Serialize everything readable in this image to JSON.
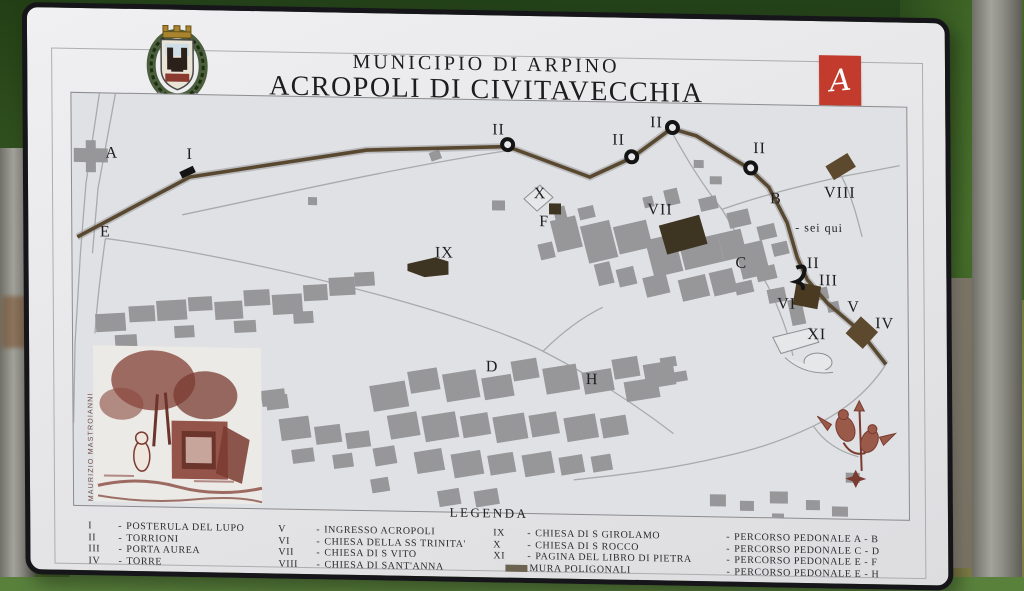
{
  "sign": {
    "title_line1": "MUNICIPIO DI ARPINO",
    "title_line2": "ACROPOLI DI CIVITAVECCHIA",
    "logo_caption": "Archeo Club Arpino",
    "credit": "MAURIZIO MASTROIANNI"
  },
  "map": {
    "you_are_here": "- sei qui",
    "labels": [
      {
        "t": "A",
        "x": 40,
        "y": 60
      },
      {
        "t": "I",
        "x": 118,
        "y": 60
      },
      {
        "t": "E",
        "x": 33,
        "y": 139
      },
      {
        "t": "II",
        "x": 427,
        "y": 30
      },
      {
        "t": "II",
        "x": 547,
        "y": 38
      },
      {
        "t": "II",
        "x": 585,
        "y": 20
      },
      {
        "t": "II",
        "x": 688,
        "y": 44
      },
      {
        "t": "II",
        "x": 741,
        "y": 158
      },
      {
        "t": "X",
        "x": 468,
        "y": 93
      },
      {
        "t": "F",
        "x": 472,
        "y": 121
      },
      {
        "t": "VII",
        "x": 588,
        "y": 107
      },
      {
        "t": "B",
        "x": 704,
        "y": 94
      },
      {
        "t": "VIII",
        "x": 768,
        "y": 87
      },
      {
        "t": "IX",
        "x": 372,
        "y": 154
      },
      {
        "t": "C",
        "x": 669,
        "y": 159
      },
      {
        "t": "III",
        "x": 756,
        "y": 175
      },
      {
        "t": "VI",
        "x": 714,
        "y": 199
      },
      {
        "t": "V",
        "x": 781,
        "y": 201
      },
      {
        "t": "IV",
        "x": 812,
        "y": 217
      },
      {
        "t": "XI",
        "x": 744,
        "y": 229
      },
      {
        "t": "D",
        "x": 419,
        "y": 267
      },
      {
        "t": "H",
        "x": 519,
        "y": 278
      },
      {
        "t": "- sei qui",
        "x": 747,
        "y": 122,
        "s": 12
      }
    ],
    "towers": [
      {
        "x": 436,
        "y": 44
      },
      {
        "x": 560,
        "y": 54
      },
      {
        "x": 601,
        "y": 24
      },
      {
        "x": 679,
        "y": 63
      }
    ]
  },
  "legend": {
    "heading": "LEGENDA",
    "columns": [
      {
        "key_width": 26,
        "entries": [
          {
            "key": "I",
            "text": "POSTERULA DEL LUPO"
          },
          {
            "key": "II",
            "text": "TORRIONI"
          },
          {
            "key": "III",
            "text": "PORTA AUREA"
          },
          {
            "key": "IV",
            "text": "TORRE"
          }
        ]
      },
      {
        "key_width": 34,
        "entries": [
          {
            "key": "V",
            "text": "INGRESSO ACROPOLI"
          },
          {
            "key": "VI",
            "text": "CHIESA DELLA SS TRINITA'"
          },
          {
            "key": "VII",
            "text": "CHIESA DI S VITO"
          },
          {
            "key": "VIII",
            "text": "CHIESA DI SANT'ANNA"
          }
        ]
      },
      {
        "key_width": 30,
        "entries": [
          {
            "key": "IX",
            "text": "CHIESA DI S GIROLAMO"
          },
          {
            "key": "X",
            "text": "CHIESA DI S ROCCO"
          },
          {
            "key": "XI",
            "text": "PAGINA DEL LIBRO DI PIETRA"
          },
          {
            "key": "",
            "text": "MURA POLIGONALI",
            "swatch": true
          }
        ]
      },
      {
        "key_width": 4,
        "entries": [
          {
            "key": "",
            "text": "PERCORSO PEDONALE  A - B"
          },
          {
            "key": "",
            "text": "PERCORSO PEDONALE  C - D"
          },
          {
            "key": "",
            "text": "PERCORSO PEDONALE  E - F"
          },
          {
            "key": "",
            "text": "PERCORSO PEDONALE  E - H"
          }
        ]
      }
    ]
  },
  "colors": {
    "logo_red": "#c23b2c",
    "wall_brown": "#58482f",
    "building_gray": "#97979a",
    "engraving_maroon": "#7a3b30",
    "swatch_brown": "#6b6250"
  }
}
